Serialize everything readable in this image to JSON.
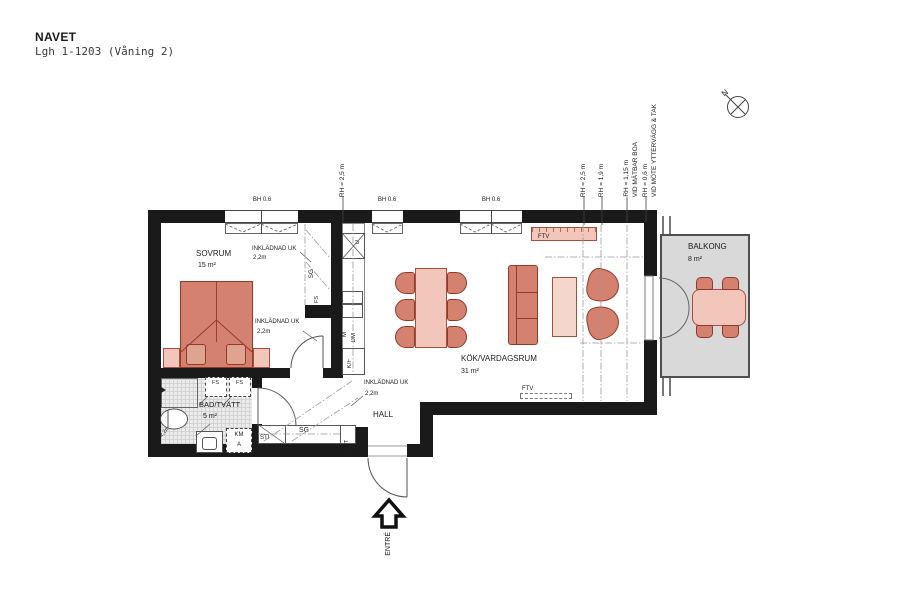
{
  "header": {
    "title": "NAVET",
    "subtitle": "Lgh 1-1203 (Våning 2)"
  },
  "compass": {
    "north": "N"
  },
  "rooms": {
    "sovrum": {
      "name": "SOVRUM",
      "area": "15 m²"
    },
    "kok": {
      "name": "KÖK/VARDAGSRUM",
      "area": "31 m²"
    },
    "bad": {
      "name": "BAD/TVÄTT",
      "area": "5 m²"
    },
    "hall": {
      "name": "HALL"
    },
    "balkong": {
      "name": "BALKONG",
      "area": "8 m²"
    }
  },
  "windows": {
    "bh1": "BH 0.6",
    "bh2": "BH 0.6",
    "bh3": "BH 0.6"
  },
  "ceiling_heights": {
    "left": "RH = 2,5 m",
    "r1": "RH = 2,5 m",
    "r2": "RH = 1,9 m",
    "r3a": "RH = 1,15 m",
    "r3b": "VID MÄTBAR BOA",
    "r4a": "RH = 0,6 m",
    "r4b": "VID MÖTE YTTERVÄGG & TAK",
    "bath": "RH 2,2m"
  },
  "bulkheads": {
    "label": "INKLÄDNAD UK",
    "height": "2,2m"
  },
  "fixtures": {
    "sg_bedroom": "SG",
    "fs_bedroom": "FS",
    "u": "U",
    "m": "M",
    "dm": "DM",
    "kf": "K/F",
    "ftv_top": "FTV",
    "ftv_bottom": "FTV",
    "fs1": "FS",
    "fs2": "FS",
    "km": "KM",
    "km_a": "A",
    "sti": "STI",
    "sg_hall": "SG",
    "elit": "EL/IT"
  },
  "entrance": {
    "label": "ENTRÉ"
  },
  "colors": {
    "wall": "#1a1a1a",
    "furniture": "#d4826f",
    "furniture_light": "#f2c6ba",
    "balcony_slab": "#d9d9d9",
    "accent_border": "#93392a"
  }
}
